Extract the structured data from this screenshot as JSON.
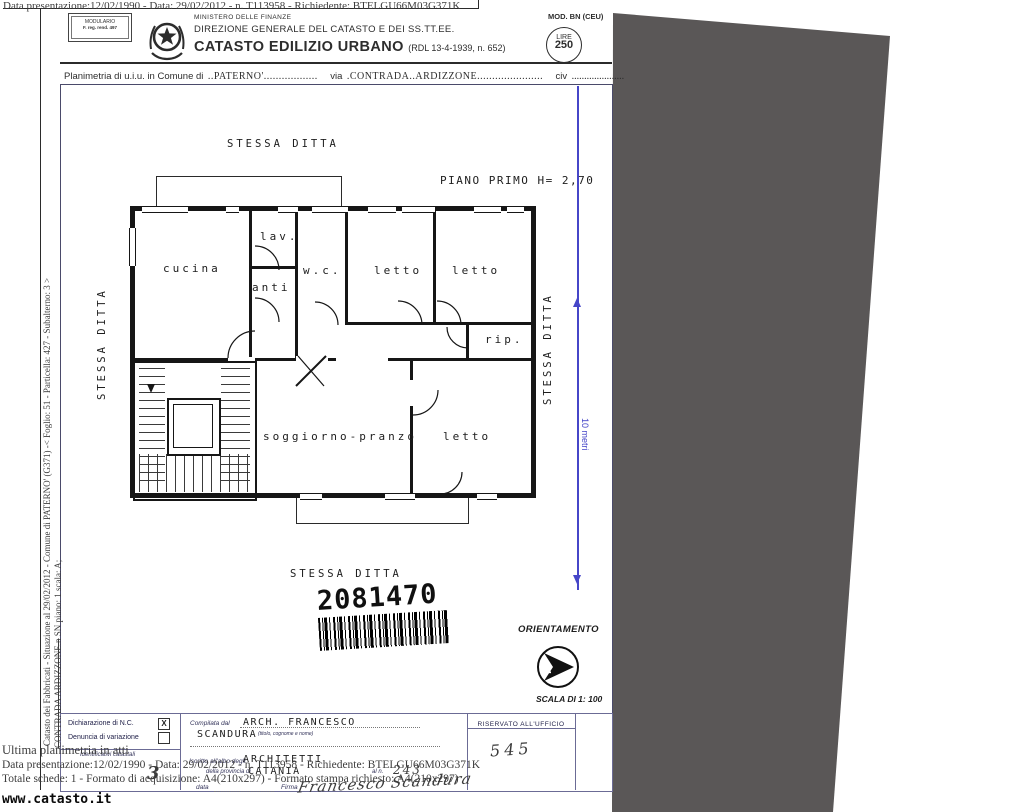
{
  "overlay": {
    "top_line": "Data presentazione:12/02/1990 - Data: 29/02/2012 - n. T113958 - Richiedente: BTELGU66M03G371K",
    "side_line1": "Catasto dei Fabbricati - Situazione al 29/02/2012 - Comune di PATERNO' (G371) -< Foglio: 51 - Particella: 427 - Subalterno: 3 >",
    "side_line2_struck": "CONTRADA ARDIZZONE.n",
    "side_line2_rest": " SN piano: 1 scala: A;",
    "bottom_line1": "Ultima planimetria in atti",
    "bottom_line2": "Data presentazione:12/02/1990 - Data: 29/02/2012 - n. T113958 - Richiedente: BTELGU66M03G371K",
    "bottom_line3": "Totale schede: 1 - Formato di acquisizione: A4(210x297) - Formato stampa richiesto: A4(210x297)",
    "handwritten_3": "3",
    "watermark": "www.catasto.it"
  },
  "header": {
    "modulario_line1": "MODULARIO",
    "modulario_line2": "F. reg. rend. 497",
    "ministry": "MINISTERO DELLE FINANZE",
    "direction": "DIREZIONE GENERALE DEL CATASTO E DEI SS.TT.EE.",
    "title": "CATASTO EDILIZIO URBANO",
    "title_ref": "(RDL 13-4-1939, n. 652)",
    "mod_label": "MOD. BN (CEU)",
    "stamp_top": "LIRE",
    "stamp_value": "250"
  },
  "intro": {
    "label1": "Planimetria di u.i.u. in Comune di",
    "comune": "..PATERNO'..................",
    "label2": "via",
    "via": ".CONTRADA..ARDIZZONE......................",
    "label3": "civ",
    "civ": "....................."
  },
  "plan": {
    "floor_label": "PIANO PRIMO H= 2,70",
    "stessa_top": "STESSA DITTA",
    "stessa_left": "STESSA DITTA",
    "stessa_right": "STESSA DITTA",
    "stessa_bottom": "STESSA DITTA",
    "scale_10m": "10 metri",
    "rooms": {
      "cucina": "cucina",
      "lav": "lav.",
      "anti": "anti",
      "wc": "w.c.",
      "letto1": "letto",
      "letto2": "letto",
      "rip": "rip.",
      "soggiorno": "soggiorno-pranzo",
      "letto3": "letto"
    },
    "barcode_number": "2081470",
    "orientation_label": "ORIENTAMENTO",
    "north_letter": "N",
    "scale_label": "SCALA DI 1: 100"
  },
  "form": {
    "check1_label": "Dichiarazione di N.C.",
    "check1_mark": "X",
    "check2_label": "Denuncia di  variazione",
    "ident_label": "Identificativi catastali",
    "compilata_label": "Compilata dal",
    "compilata_value1": "ARCH. FRANCESCO",
    "compilata_value2": "SCANDURA",
    "compilata_note": "(titolo, cognome e nome)",
    "iscritto_label": "Iscritto all'albo degli",
    "albo_value": "ARCHITETTI",
    "provincia_label": "della provincia di",
    "provincia_value": "CATANIA",
    "al_n_label": "al n.",
    "al_n_value": "243",
    "data_label": "data",
    "firma_label": "Firma",
    "signature": "Francesco Scandura",
    "riservato_label": "RISERVATO ALL'UFFICIO",
    "riservato_value": "545"
  },
  "colors": {
    "scanner_bg": "#5a5757",
    "dimension_blue": "#4646c8",
    "form_line_blue": "#6b6b95",
    "ink": "#1d1d1d"
  }
}
